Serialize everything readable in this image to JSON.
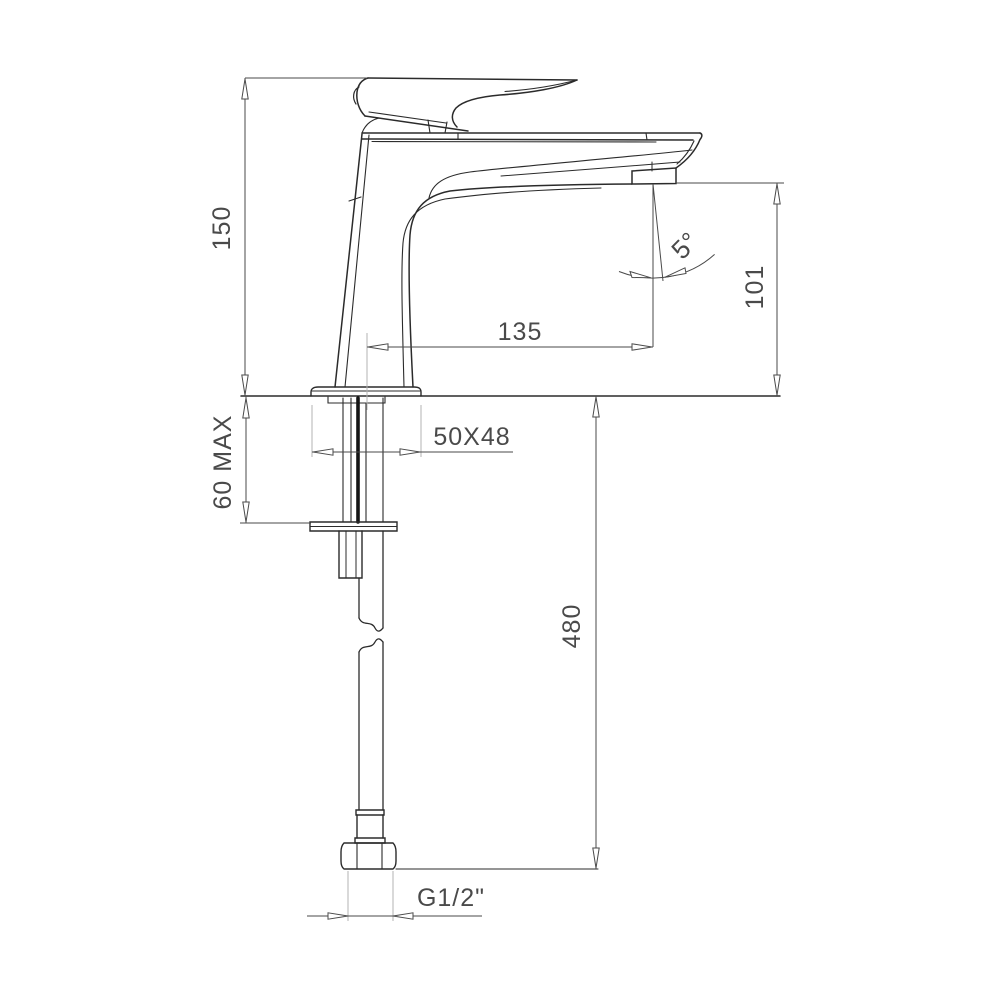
{
  "drawing": {
    "kind": "faucet-dimensional-elevation",
    "units": "mm",
    "colors": {
      "background": "#ffffff",
      "outline": "#2b2b2b",
      "dimension": "#4a4a4a",
      "extension": "#b3b3b3",
      "supply_core": "#141414"
    },
    "dimensions": {
      "spout_height": {
        "label": "150",
        "orientation": "vertical"
      },
      "mounting_thickness": {
        "label": "60 MAX",
        "orientation": "vertical"
      },
      "spout_reach": {
        "label": "135",
        "orientation": "horizontal"
      },
      "spout_to_counter": {
        "label": "101",
        "orientation": "vertical"
      },
      "hose_length": {
        "label": "480",
        "orientation": "vertical"
      },
      "base_footprint": {
        "label": "50X48",
        "orientation": "horizontal"
      },
      "stream_angle": {
        "label": "5°"
      },
      "connection_thread": {
        "label": "G1/2\""
      }
    },
    "components": [
      "lever-handle",
      "faucet-body",
      "spout",
      "aerator",
      "base-plate",
      "counter-line",
      "threaded-shank",
      "mounting-washer",
      "supply-hose",
      "hose-break-symbol",
      "connector-hex-nut"
    ]
  }
}
